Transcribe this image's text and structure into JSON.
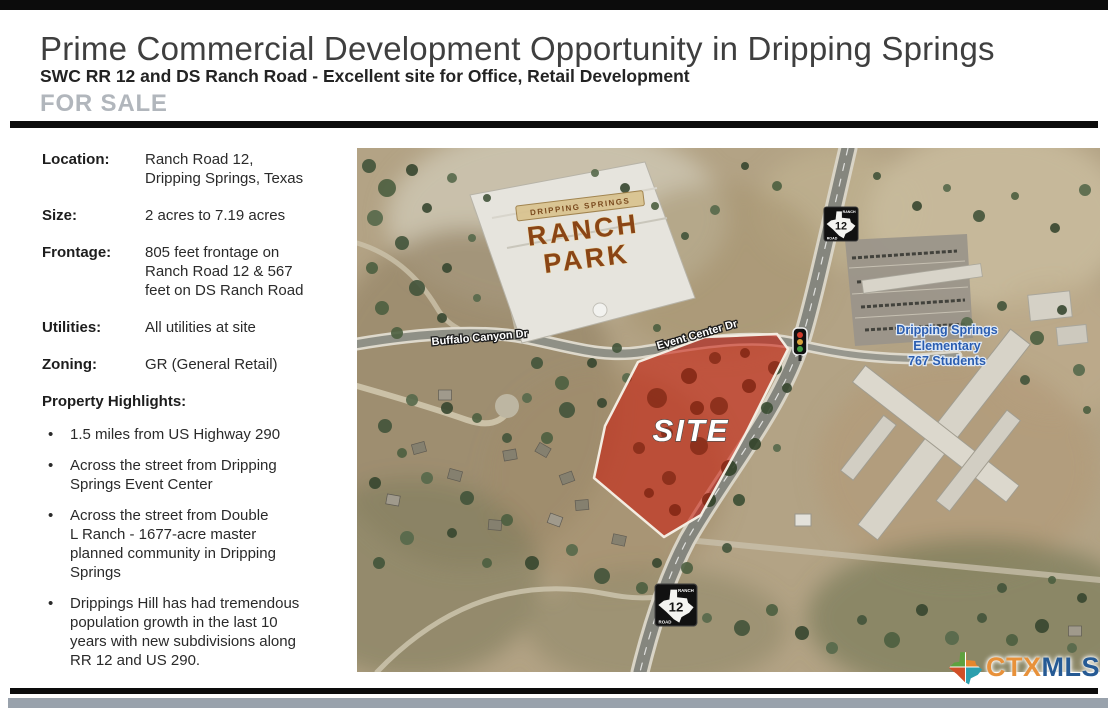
{
  "header": {
    "title": "Prime Commercial Development Opportunity in Dripping Springs",
    "subtitle": "SWC RR 12 and DS Ranch Road - Excellent site for Office, Retail Development",
    "for_sale_label": "FOR SALE"
  },
  "details": {
    "rows": [
      {
        "label": "Location:",
        "value": "Ranch Road 12,\nDripping Springs, Texas"
      },
      {
        "label": "Size:",
        "value": "2 acres to 7.19 acres"
      },
      {
        "label": "Frontage:",
        "value": "805 feet frontage on\nRanch Road 12 & 567\nfeet on DS Ranch Road"
      },
      {
        "label": "Utilities:",
        "value": "All utilities at site"
      },
      {
        "label": "Zoning:",
        "value": "GR (General Retail)"
      }
    ],
    "highlights_title": "Property Highlights:",
    "bullet": "•",
    "highlights": [
      "1.5 miles from US Highway 290",
      "Across the street from Dripping\nSprings Event Center",
      "Across the street from Double\nL Ranch - 1677-acre master\nplanned community in Dripping\nSprings",
      "Drippings Hill has had tremendous\npopulation growth in the last 10\nyears with new subdivisions along\nRR 12 and US 290."
    ]
  },
  "map": {
    "site_label": "SITE",
    "roads": {
      "buffalo": "Buffalo Canyon Dr",
      "event": "Event Center Dr"
    },
    "ranch_park": {
      "top": "DRIPPING SPRINGS",
      "line1": "RANCH",
      "line2": "PARK"
    },
    "school": {
      "line1": "Dripping Springs",
      "line2": "Elementary",
      "line3": "767 Students"
    },
    "shield": {
      "top": "RANCH",
      "route": "12",
      "bottom": "ROAD"
    },
    "colors": {
      "site_fill": "#cb1405",
      "school_label": "#2a5db0",
      "sign_brown": "#8a4516"
    }
  },
  "footer": {
    "logo_ctx": "CTX",
    "logo_mls": "MLS"
  }
}
